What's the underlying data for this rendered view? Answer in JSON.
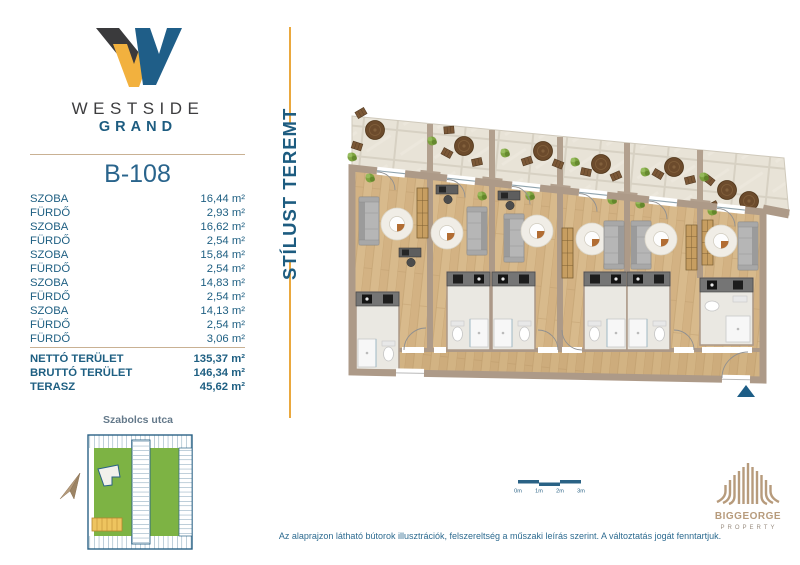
{
  "brand": {
    "line1": "WESTSIDE",
    "line2": "GRAND"
  },
  "unit": {
    "id": "B-108"
  },
  "room_rows": [
    {
      "label": "SZOBA",
      "area": "16,44 m²"
    },
    {
      "label": "FÜRDŐ",
      "area": "2,93 m²"
    },
    {
      "label": "SZOBA",
      "area": "16,62 m²"
    },
    {
      "label": "FÜRDŐ",
      "area": "2,54 m²"
    },
    {
      "label": "SZOBA",
      "area": "15,84 m²"
    },
    {
      "label": "FÜRDŐ",
      "area": "2,54 m²"
    },
    {
      "label": "SZOBA",
      "area": "14,83 m²"
    },
    {
      "label": "FÜRDŐ",
      "area": "2,54 m²"
    },
    {
      "label": "SZOBA",
      "area": "14,13 m²"
    },
    {
      "label": "FÜRDŐ",
      "area": "2,54 m²"
    },
    {
      "label": "FÜRDŐ",
      "area": "3,06 m²"
    }
  ],
  "totals": [
    {
      "label": "NETTÓ TERÜLET",
      "area": "135,37 m²"
    },
    {
      "label": "BRUTTÓ TERÜLET",
      "area": "146,34 m²"
    },
    {
      "label": "TERASZ",
      "area": "45,62 m²"
    }
  ],
  "tagline": "STÍLUST TEREMT",
  "minimap": {
    "street": "Szabolcs utca"
  },
  "scalebar": {
    "labels": [
      "0m",
      "1m",
      "2m",
      "3m"
    ]
  },
  "disclaimer": "Az alaprajzon látható bútorok illusztrációk, felszereltség a műszaki leírás szerint. A változtatás jogát fenntartjuk.",
  "developer": {
    "name": "BIGGEORGE",
    "division": "PROPERTY"
  },
  "colors": {
    "accent_blue": "#1f5e86",
    "accent_gold": "#eaa83e",
    "wall_tan": "#ad9a88",
    "logo_yellow": "#f2b13e",
    "logo_dark": "#3a3a3c"
  }
}
